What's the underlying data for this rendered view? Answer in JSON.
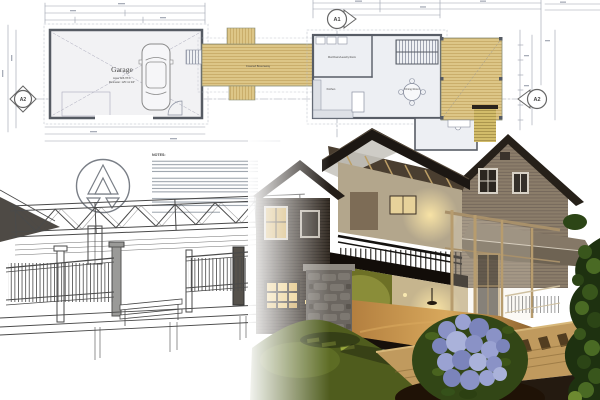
{
  "scene": {
    "title": "Architectural blueprint with 3D cutaway house rendering"
  },
  "blueprint": {
    "garage": {
      "label": "Garage",
      "area_text": "Area: 926.78 ft²",
      "perimeter_text": "Perimeter: 125'-11 3/4\""
    },
    "breezeway": {
      "label": "Covered Breezeway"
    },
    "house": {
      "rooms": [
        {
          "label": "Mud Room/Laundry Room"
        },
        {
          "label": "Kitchen"
        },
        {
          "label": "Dining Room"
        }
      ]
    },
    "markers": [
      {
        "id": "A1",
        "position": "top"
      },
      {
        "id": "A2",
        "position": "left"
      },
      {
        "id": "A2",
        "position": "right"
      }
    ],
    "notes": {
      "heading": "NOTES:"
    }
  },
  "palette": {
    "paper": "#ffffff",
    "blueprint_line": "#8a90a0",
    "wall_line": "#565b63",
    "plan_wood": "#ddc687",
    "sketch_line": "#4a4a4a",
    "roof_dark": "#1c1713",
    "siding_taupe": "#8b7d6a",
    "siding_dark": "#342c24",
    "interior_olive": "#6d7026",
    "interior_warm": "#c6b58e",
    "window_glow": "#f2d88a",
    "stone_grey": "#6b6660",
    "deck_wood": "#c09a5e",
    "lawn_green": "#4f5c1d",
    "hydrangea_purple": "#8a92c6",
    "foliage_dark": "#1e3110"
  }
}
